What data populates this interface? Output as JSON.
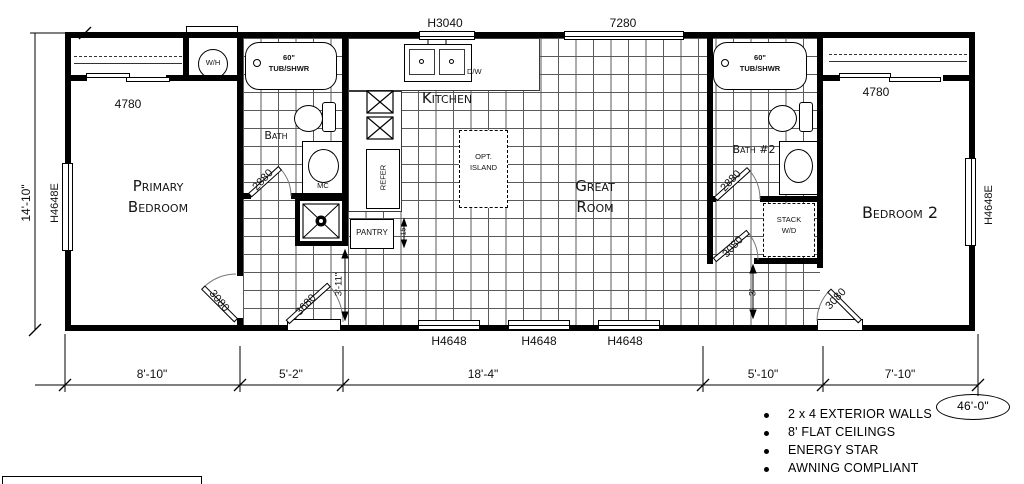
{
  "rooms": {
    "primary_bedroom": "Primary Bedroom",
    "kitchen": "Kitchen",
    "great_room": "Great Room",
    "bath": "Bath",
    "bath2": "Bath #2",
    "bedroom2": "Bedroom 2"
  },
  "fixtures": {
    "water_heater": "W/H",
    "tub_size": "60\"",
    "tub_type": "TUB/SHWR",
    "dishwasher": "D/W",
    "refrigerator": "REFER",
    "pantry": "PANTRY",
    "medicine_cabinet": "MC",
    "island_line1": "OPT.",
    "island_line2": "ISLAND",
    "stack_line1": "STACK",
    "stack_line2": "W/D"
  },
  "windows": {
    "left": "H4648E",
    "right": "H4648E",
    "kitchen": "H3040",
    "great_room": "7280",
    "closet_primary": "4780",
    "closet_bedroom2": "4780",
    "rear": "H4648"
  },
  "doors": {
    "bath": "2880",
    "primary_bedroom": "3080",
    "exterior_left": "3680",
    "bath2": "2880",
    "hall": "3080",
    "exterior_right": "3080"
  },
  "dimensions": {
    "side_height": "14'-10\"",
    "bottom_segments": [
      "8'-10\"",
      "5'-2\"",
      "18'-4\"",
      "5'-10\"",
      "7'-10\""
    ],
    "overall_length": "46'-0\"",
    "hall_left": "3'-11\"",
    "hall_right": "3'",
    "pantry_depth": "15"
  },
  "features": [
    "2 x 4 EXTERIOR WALLS",
    "8' FLAT CEILINGS",
    "ENERGY STAR",
    "AWNING COMPLIANT"
  ]
}
